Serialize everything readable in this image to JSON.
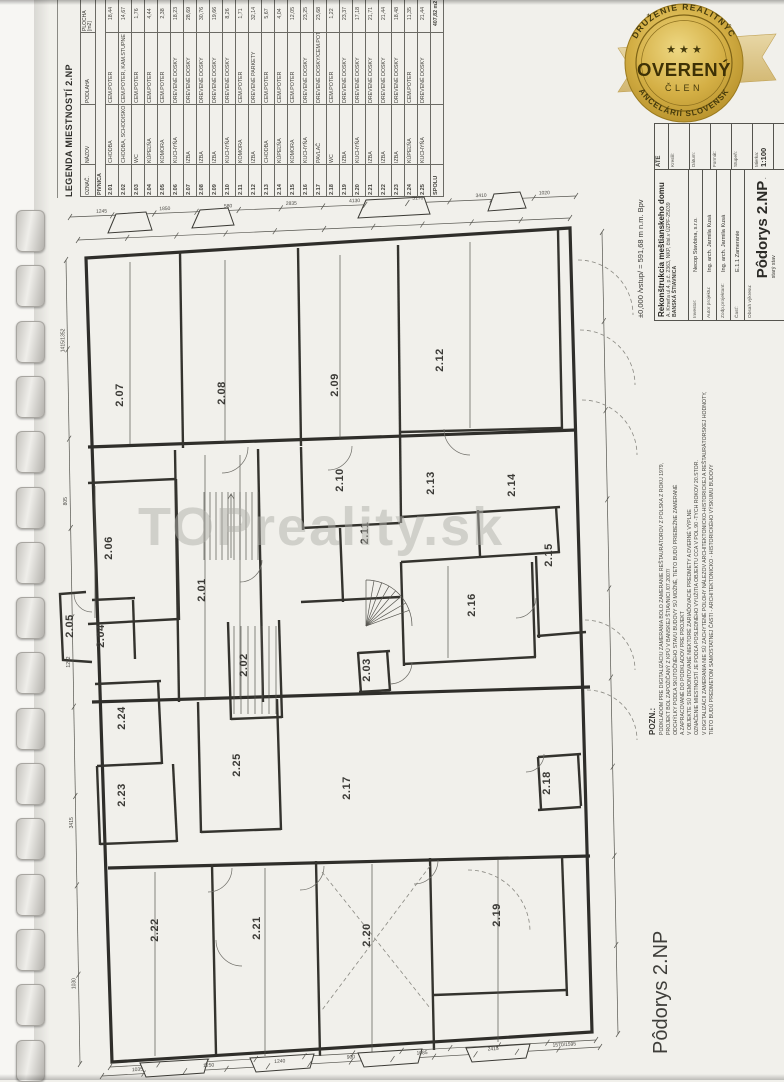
{
  "page": {
    "watermark": "TOPreality.sk"
  },
  "legend": {
    "title": "LEGENDA MIESTNOSTÍ 2.NP",
    "headers": {
      "code": "OZNAČ.",
      "name": "NÁZOV",
      "floor": "PODLAHA",
      "area": "PLOCHA",
      "area_unit": "[m2]"
    },
    "section": "PIVNICA",
    "rows": [
      {
        "code": "2.01",
        "name": "CHODBA",
        "floor": "CEM.POTER",
        "area": "18,44"
      },
      {
        "code": "2.02",
        "name": "CHODBA, SCHODISKO",
        "floor": "CEM.POTER, KAM.STUPNE",
        "area": "14,67"
      },
      {
        "code": "2.03",
        "name": "WC",
        "floor": "CEM.POTER",
        "area": "1,76"
      },
      {
        "code": "2.04",
        "name": "KÚPEĽŇA",
        "floor": "CEM.POTER",
        "area": "4,44"
      },
      {
        "code": "2.05",
        "name": "KOMORA",
        "floor": "CEM.POTER",
        "area": "2,38"
      },
      {
        "code": "2.06",
        "name": "KUCHYŇA",
        "floor": "DREVENÉ DOSKY",
        "area": "18,23"
      },
      {
        "code": "2.07",
        "name": "IZBA",
        "floor": "DREVENÉ DOSKY",
        "area": "28,69"
      },
      {
        "code": "2.08",
        "name": "IZBA",
        "floor": "DREVENÉ DOSKY",
        "area": "30,76"
      },
      {
        "code": "2.09",
        "name": "IZBA",
        "floor": "DREVENÉ DOSKY",
        "area": "19,66"
      },
      {
        "code": "2.10",
        "name": "KUCHYŇA",
        "floor": "DREVENÉ DOSKY",
        "area": "8,26"
      },
      {
        "code": "2.11",
        "name": "KOMORA",
        "floor": "CEM.POTER",
        "area": "1,71"
      },
      {
        "code": "2.12",
        "name": "IZBA",
        "floor": "DREVENÉ PARKETY",
        "area": "32,14"
      },
      {
        "code": "2.13",
        "name": "CHODBA",
        "floor": "CEM.POTER",
        "area": "5,67"
      },
      {
        "code": "2.14",
        "name": "KÚPEĽŇA",
        "floor": "CEM.POTER",
        "area": "4,04"
      },
      {
        "code": "2.15",
        "name": "KOMORA",
        "floor": "CEM.POTER",
        "area": "12,05"
      },
      {
        "code": "2.16",
        "name": "KUCHYŇA",
        "floor": "DREVENÉ DOSKY",
        "area": "23,25"
      },
      {
        "code": "2.17",
        "name": "PAVLAČ",
        "floor": "DREVENÉ DOSKY/CEM.POTER",
        "area": "23,68"
      },
      {
        "code": "2.18",
        "name": "WC",
        "floor": "CEM.POTER",
        "area": "1,22"
      },
      {
        "code": "2.19",
        "name": "IZBA",
        "floor": "DREVENÉ DOSKY",
        "area": "23,37"
      },
      {
        "code": "2.20",
        "name": "KUCHYŇA",
        "floor": "DREVENÉ DOSKY",
        "area": "17,18"
      },
      {
        "code": "2.21",
        "name": "IZBA",
        "floor": "DREVENÉ DOSKY",
        "area": "21,71"
      },
      {
        "code": "2.22",
        "name": "IZBA",
        "floor": "DREVENÉ DOSKY",
        "area": "21,44"
      },
      {
        "code": "2.23",
        "name": "IZBA",
        "floor": "DREVENÉ DOSKY",
        "area": "18,48"
      },
      {
        "code": "2.24",
        "name": "KÚPEĽŇA",
        "floor": "CEM.POTER",
        "area": "11,35"
      },
      {
        "code": "2.25",
        "name": "KUCHYŇA",
        "floor": "DREVENÉ DOSKY",
        "area": "21,44"
      },
      {
        "code": "SPOLU",
        "name": "",
        "floor": "",
        "area": "407,82 m2"
      }
    ]
  },
  "badge": {
    "arc_top": "ZDRUŽENIE REALITNÝCH",
    "arc_bottom": "KANCELÁRIÍ SLOVENSKA",
    "stars": "★ ★ ★",
    "title": "OVERENÝ",
    "subtitle": "ČLEN",
    "gold": "#c9a43c",
    "text_color": "#453a0c"
  },
  "titleblock": {
    "elevation_note": "±0,000 /vstup/ = 591,68 m n.m. Bpv",
    "project_title": "Rekonštrukcia meštianskeho domu",
    "project_address": "A. Kmeťa ul.4, p.č. 2363, NKP, čísl.v ÚZPF-25039",
    "project_city": "BANSKÁ ŠTIAVNICA",
    "fields": [
      {
        "label": "Investor:",
        "value": "Necop Stavbina, s.r.o."
      },
      {
        "label": "Autor projektu:",
        "value": "Ing. arch. Jarmila Kusá"
      },
      {
        "label": "Zodp.projektant:",
        "value": "Ing. arch. Jarmila Kusá"
      },
      {
        "label": "Časť:",
        "value": "E.1.1 Zameranie"
      }
    ],
    "drawing_label": "Obsah výkresu:",
    "drawing_title": "Pôdorys 2.NP",
    "drawing_suffix": "- starý stav",
    "corner_text": "ATE",
    "side_fields": [
      {
        "label": "Kreslil:",
        "value": ""
      },
      {
        "label": "Dátum:",
        "value": ""
      },
      {
        "label": "Formát:",
        "value": ""
      },
      {
        "label": "Stupeň:",
        "value": ""
      },
      {
        "label": "Mierka:",
        "value": "1:100"
      }
    ]
  },
  "note": {
    "heading": "POZN.:",
    "lines": [
      "PODKLADOM PRE DIGITALIZÁCIU ZAMERANIA BOLO ZAMERANIE REŠTAURÁTOROV Z POLSKA Z ROKU 1979,",
      "PROJEKT BOL ZAPOŽIČANÝ Z KPÚ V BANSKEJ ŠTIAVNICI /07.2007/",
      "ODCHÝLKY PODĽA SKUTOČNÉHO STAVU BUDOVY SÚ MOŽNÉ, TIETO BUDÚ PRIEBEŽNE ZAMERANÉ",
      "A ZAPRACOVANÉ DO PODKLADOV PRE PROJEKT",
      "V OBJEKTE SÚ DEMONTOVANÉ NIEKTORÉ ZARIAĎOVACIE PREDMETY A DVERNÉ VÝPLNE",
      "OZNAČENIE MIESTNOSTÍ JE PODĽA POSLEDNÉHO VYUŽITIA OBJEKTU CCA V POL.90 -TYCH ROKOV 20.STOR.",
      "V DIGITALIZÁCII ZAMERANIA NIE SÚ ZACHYTENÉ POLOHY NÁLEZOV ARCHITEKTONICKO-HISTORICKEJ A REŠTAURÁTORSKEJ HODNOTY,",
      "TIETO BUDÚ PREDMETOM SAMOSTATNEJ ČASTI - ARCHITEKTONICKO - HISTORICKÉHO VÝSKUMU BUDOVY"
    ]
  },
  "footer": {
    "drawing_title": "Pôdorys 2.NP"
  },
  "plan": {
    "rooms": [
      {
        "id": "2.01",
        "x": 205,
        "y": 590
      },
      {
        "id": "2.02",
        "x": 247,
        "y": 665
      },
      {
        "id": "2.03",
        "x": 370,
        "y": 670
      },
      {
        "id": "2.04",
        "x": 104,
        "y": 636
      },
      {
        "id": "2.05",
        "x": 73,
        "y": 626
      },
      {
        "id": "2.06",
        "x": 112,
        "y": 548
      },
      {
        "id": "2.07",
        "x": 123,
        "y": 395
      },
      {
        "id": "2.08",
        "x": 225,
        "y": 393
      },
      {
        "id": "2.09",
        "x": 338,
        "y": 385
      },
      {
        "id": "2.10",
        "x": 343,
        "y": 480
      },
      {
        "id": "2.11",
        "x": 368,
        "y": 533
      },
      {
        "id": "2.12",
        "x": 443,
        "y": 360
      },
      {
        "id": "2.13",
        "x": 434,
        "y": 483
      },
      {
        "id": "2.14",
        "x": 515,
        "y": 485
      },
      {
        "id": "2.15",
        "x": 552,
        "y": 555
      },
      {
        "id": "2.16",
        "x": 475,
        "y": 605
      },
      {
        "id": "2.17",
        "x": 350,
        "y": 788
      },
      {
        "id": "2.18",
        "x": 550,
        "y": 783
      },
      {
        "id": "2.19",
        "x": 500,
        "y": 915
      },
      {
        "id": "2.20",
        "x": 370,
        "y": 935
      },
      {
        "id": "2.21",
        "x": 260,
        "y": 928
      },
      {
        "id": "2.22",
        "x": 158,
        "y": 930
      },
      {
        "id": "2.23",
        "x": 125,
        "y": 795
      },
      {
        "id": "2.24",
        "x": 125,
        "y": 718
      },
      {
        "id": "2.25",
        "x": 240,
        "y": 765
      }
    ],
    "dims": [
      "1245",
      "1850",
      "580",
      "2835",
      "4130",
      "5170",
      "3410",
      "1020",
      "1035",
      "1250",
      "1240",
      "900",
      "1085",
      "2415",
      "1570/1595",
      "1415/1352",
      "805",
      "1252",
      "3415",
      "1030"
    ]
  }
}
